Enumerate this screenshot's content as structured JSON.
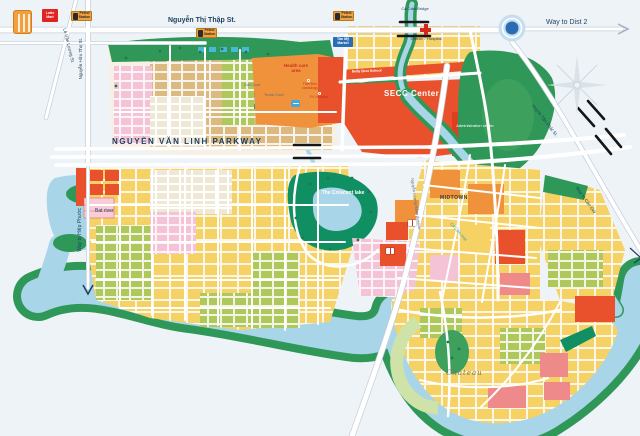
{
  "map_name": "Phu My Hung area map",
  "roads": {
    "nguyen_thi_thap": "Nguyễn Thị Thập St.",
    "way_to_dist_2": "Way to Dist 2",
    "nguyen_van_linh": "NGUYỄN VĂN LINH PARKWAY",
    "nguyen_huu_tho": "Nguyễn Hữu Thọ St.",
    "le_van_luong": "Lê Văn Lương St.",
    "way_to_hiep_phuoc": "Way to Hiệp Phước",
    "huynh_tan_phat": "Huỳnh Tấn Phát St.",
    "way_to_can_gio": "Way to Cần Giờ",
    "nguyen_luong_bang": "Nguyễn Lương Bằng Avenue"
  },
  "places": {
    "secc": "SECC Center",
    "administration_center": "Administration center",
    "health_care_area": "Health care area",
    "fv_hospital": "FV Hospital",
    "tam_duc_cardiology": "Tâm Đức cardiology",
    "district_7_hospital": "District 7 Hospital",
    "tan_my_market": "Tân Mỹ Market",
    "lotte_mart": "Lotte Mart",
    "petrol_station": "Petrol Station",
    "school": "Belly Best School",
    "midtown": "MIDTOWN",
    "the_crescent_lake": "The Crescent lake",
    "chateau": "Chateau",
    "golf_court": "Golf Court",
    "tennis_court": "Tennis Court"
  },
  "water": {
    "bat_river": "Bat river",
    "ca_cam_river": "Cả Cấm river",
    "ca_cam_bridge": "Cả Cấm Bridge"
  },
  "palette": {
    "background": "#eef3f8",
    "water": "#a8d5e8",
    "green_bank": "#2f9858",
    "park_teal": "#0f8f62",
    "olive": "#aec85b",
    "yellow_block": "#f6d264",
    "tan_block": "#dcb97e",
    "orange_block": "#f0923c",
    "red_block": "#e8512b",
    "pink_block": "#f4c3d5",
    "rose_block": "#ef8a8a",
    "road_text": "#1c3f5e",
    "market_blue": "#2a6cb5",
    "roundabout_blue": "#2a6cb3"
  }
}
